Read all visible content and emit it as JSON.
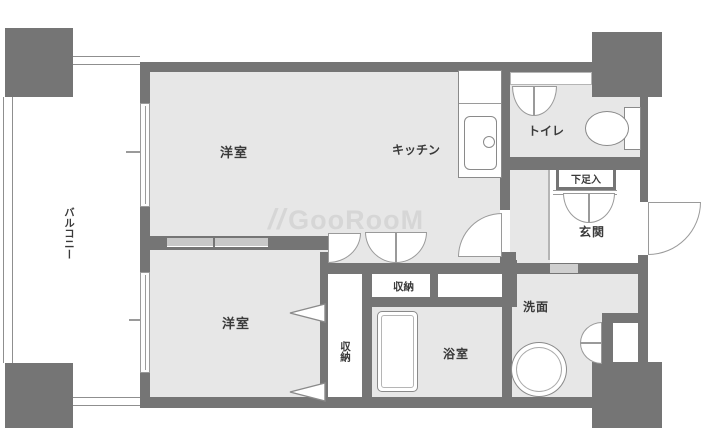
{
  "watermark": {
    "logo": "//",
    "text": "GooRooM"
  },
  "colors": {
    "wall": "#757575",
    "floor": "#e7e7e7",
    "label": "#3a3a3a",
    "watermark": "#d6d6d6",
    "line": "#9a9a9a"
  },
  "rooms": {
    "bedroom_upper": "洋室",
    "kitchen": "キッチン",
    "toilet": "トイレ",
    "shoe_cabinet": "下足入",
    "entrance": "玄関",
    "closet_hall": "収納",
    "closet_bedroom": "収納",
    "washroom": "洗面",
    "bathroom": "浴室",
    "bedroom_lower": "洋室",
    "balcony": "バルコニー"
  }
}
